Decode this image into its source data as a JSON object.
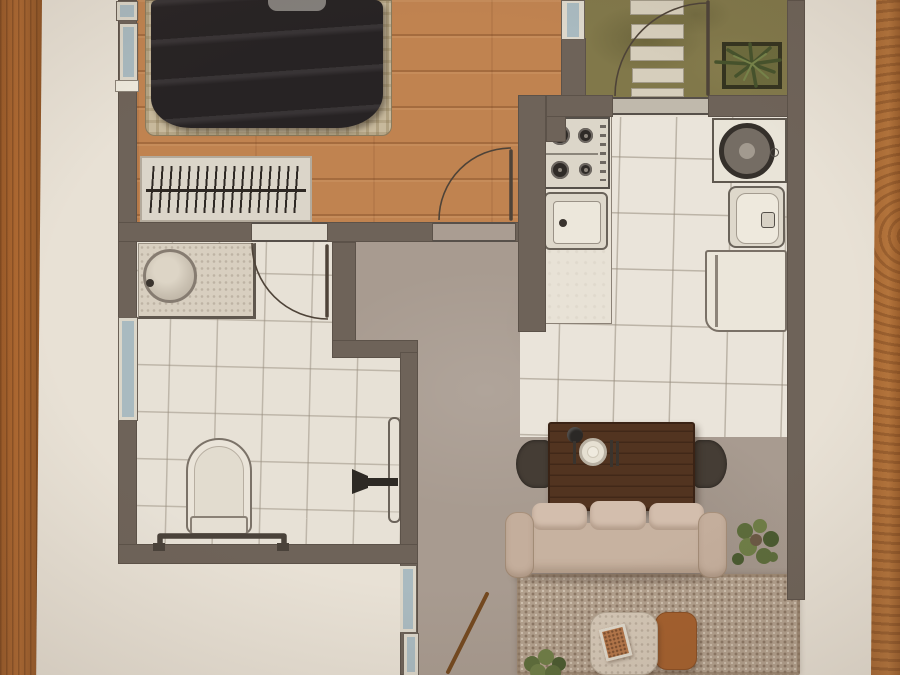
{
  "meta": {
    "kind": "photographed apartment floor plan",
    "text_visible": "none"
  },
  "palette": {
    "paper": "#e8e1d5",
    "wood_table_left": "#a8622d",
    "wood_table_right": "#b5753c",
    "wall": "#6e6359",
    "bedroom_wood_floor": "#c08350",
    "kitchen_tile": "#eae4da",
    "bathroom_tile": "#e7e1d6",
    "concrete_floor": "#a89b90",
    "grass": "#81784a",
    "window_glass": "#a9bac0",
    "duvet_dark": "#272324",
    "sofa_beige": "#cdb8a6",
    "rug_tan": "#b2a08d",
    "dining_table_walnut": "#523420",
    "coffee_table_orange": "#a4602e",
    "plant_green": "#5c6c3b"
  },
  "plan": {
    "rooms": [
      {
        "id": "bedroom",
        "floor": "wood-plank",
        "items": [
          "double-bed",
          "dark-duvet",
          "open-wardrobe-hangers",
          "window"
        ]
      },
      {
        "id": "entry-garden",
        "floor": "grass",
        "items": [
          "stepping-stones",
          "agave-planter",
          "entry-door-swing"
        ]
      },
      {
        "id": "kitchen",
        "floor": "ceramic-tile",
        "items": [
          "gas-hob-4-burners",
          "kitchen-sink",
          "counter",
          "washing-machine",
          "second-sink",
          "refrigerator"
        ]
      },
      {
        "id": "bathroom",
        "floor": "ceramic-tile",
        "items": [
          "vanity-round-basin",
          "toilet",
          "towel-rail",
          "door-leaf-with-handle",
          "door-swing"
        ]
      },
      {
        "id": "hallway",
        "floor": "concrete",
        "items": [
          "broom"
        ]
      },
      {
        "id": "living-dining",
        "floor": "concrete",
        "items": [
          "dining-table",
          "two-chairs",
          "place-setting",
          "sofa-3-seat",
          "area-rug",
          "coffee-table-stone",
          "coffee-table-orange",
          "book",
          "plant",
          "plant"
        ]
      }
    ],
    "doors": [
      "entry-door",
      "bedroom-door",
      "bathroom-door"
    ],
    "window_count": 7,
    "stepping_stone_count": 5,
    "hob_burner_count": 4,
    "sofa_cushion_count": 3
  }
}
